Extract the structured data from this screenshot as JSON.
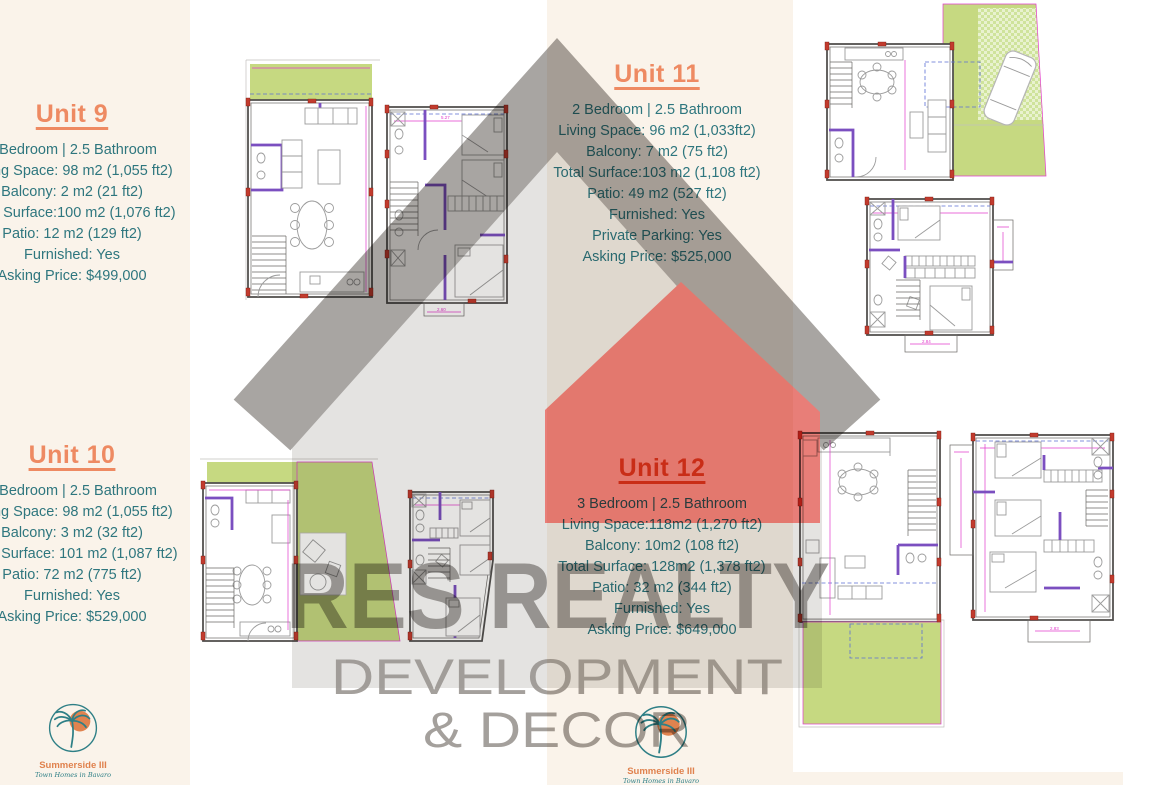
{
  "units": {
    "u9": {
      "title": "Unit 9",
      "lines": [
        "2 Bedroom | 2.5 Bathroom",
        "Living Space: 98 m2 (1,055 ft2)",
        "Balcony: 2 m2 (21 ft2)",
        "Total Surface:100 m2 (1,076 ft2)",
        "Patio: 12 m2 (129 ft2)",
        "Furnished: Yes",
        "Asking Price: $499,000"
      ]
    },
    "u10": {
      "title": "Unit 10",
      "lines": [
        "2 Bedroom | 2.5 Bathroom",
        "Living Space: 98 m2 (1,055 ft2)",
        "Balcony: 3 m2 (32 ft2)",
        "Total Surface: 101 m2 (1,087 ft2)",
        "Patio: 72 m2 (775 ft2)",
        "Furnished: Yes",
        "Asking Price: $529,000"
      ]
    },
    "u11": {
      "title": "Unit 11",
      "lines": [
        "2 Bedroom | 2.5 Bathroom",
        "Living Space: 96 m2 (1,033ft2)",
        "Balcony: 7 m2 (75 ft2)",
        "Total Surface:103 m2 (1,108 ft2)",
        "Patio: 49 m2 (527 ft2)",
        "Furnished: Yes",
        "Private Parking: Yes",
        "Asking Price: $525,000"
      ]
    },
    "u12": {
      "title": "Unit 12",
      "lines": [
        "3 Bedroom | 2.5 Bathroom",
        "Living Space:118m2 (1,270 ft2)",
        "Balcony: 10m2 (108 ft2)",
        "Total Surface: 128m2 (1,378 ft2)",
        "Patio: 32 m2 (344 ft2)",
        "Furnished: Yes",
        "Asking Price: $649,000"
      ]
    }
  },
  "watermark": {
    "brand": "RES REALTY",
    "line2": "DEVELOPMENT",
    "line3": "& DECOR",
    "icon": "house-icon"
  },
  "logo": {
    "name": "Summerside III",
    "tagline": "Town Homes in Bavaro",
    "icon": "palm-tree-sun-icon"
  },
  "plans": {
    "dimension_labels": {
      "u9_upper_top": "5.27",
      "u9_upper_bottom": "2.60",
      "u11_upper_bottom": "2.84",
      "u12_upper_bottom": "2.83"
    }
  },
  "colors": {
    "cream_band": "#faf3ea",
    "accent_coral": "#ee8a62",
    "accent_coral_dark": "#dd5a31",
    "teal_text": "#2e767e",
    "logo_orange": "#e0824e",
    "logo_teal": "#2e7f86",
    "plan_green": "#c6d981",
    "wall_purple": "#7b4fc0",
    "marker_red": "#c23b2e",
    "dim_magenta": "#e23ccc",
    "watermark_gray_dark": "#a8a5a2",
    "watermark_gray_light": "#e4e3e1",
    "watermark_red": "#e87e78",
    "watermark_text_gray": "#8b8784"
  }
}
